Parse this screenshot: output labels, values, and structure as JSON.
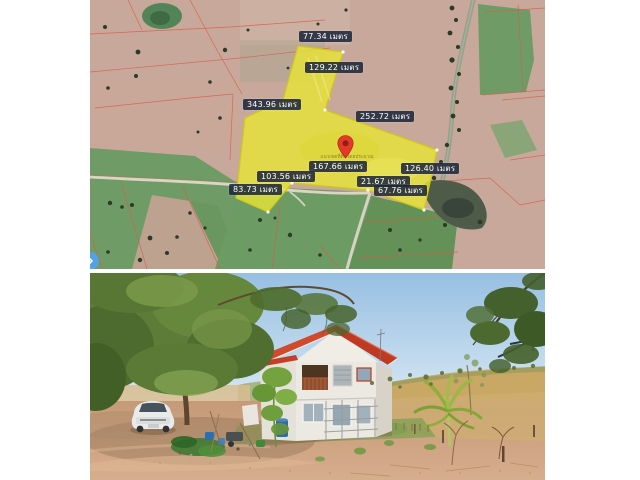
{
  "collage": {
    "top_photo_description": "satellite map of highlighted land plot with boundary measurements",
    "bottom_photo_description": "two-storey white house with red roof on rural land"
  },
  "map": {
    "unit": "เมตร",
    "measurements": [
      {
        "value": "77.34",
        "label": "77.34 เมตร",
        "side": "top-edge"
      },
      {
        "value": "129.22",
        "label": "129.22 เมตร",
        "side": "upper-strip-right-edge"
      },
      {
        "value": "343.96",
        "label": "343.96 เมตร",
        "side": "left-edge"
      },
      {
        "value": "252.72",
        "label": "252.72 เมตร",
        "side": "upper-right-edge"
      },
      {
        "value": "167.66",
        "label": "167.66 เมตร",
        "side": "bottom-center-edge"
      },
      {
        "value": "126.40",
        "label": "126.40 เมตร",
        "side": "right-edge"
      },
      {
        "value": "103.56",
        "label": "103.56 เมตร",
        "side": "lower-left-edge"
      },
      {
        "value": "21.67",
        "label": "21.67 เมตร",
        "side": "bottom-jog"
      },
      {
        "value": "83.73",
        "label": "83.73 เมตร",
        "side": "bottom-left-tail"
      },
      {
        "value": "67.76",
        "label": "67.76 เมตร",
        "side": "bottom-right-edge"
      }
    ],
    "pin_caption": "แนวเขตที่ดินโดยประมาณ",
    "colors": {
      "plot_fill": "#e9e536",
      "plot_stroke": "#cfca14",
      "label_bg": "#1d2639",
      "label_text": "#ffffff",
      "pin": "#e2392a",
      "parcel_line": "#dd5a48"
    }
  }
}
